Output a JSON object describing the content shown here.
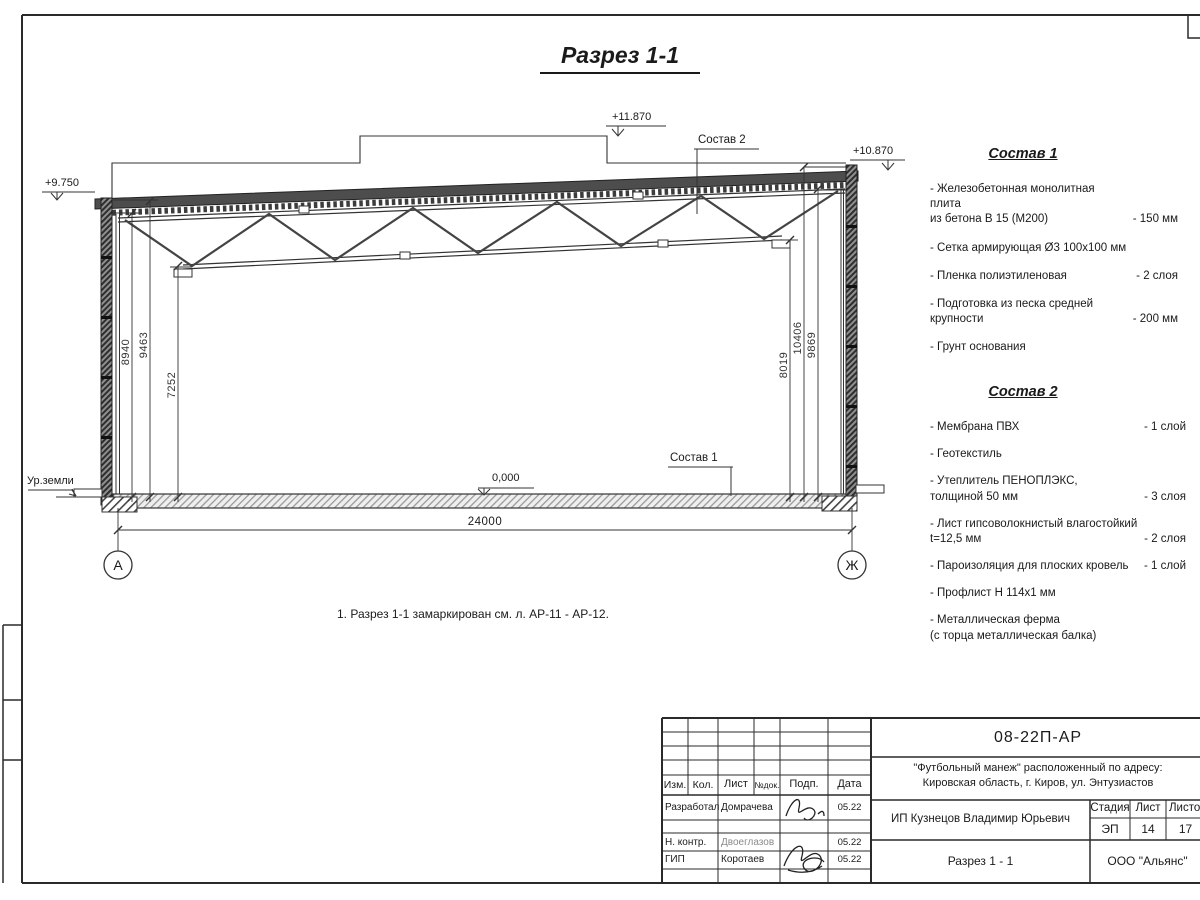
{
  "page": {
    "title": "Разрез 1-1",
    "note": "1. Разрез 1-1 замаркирован см. л. АР-11 - АР-12."
  },
  "section": {
    "elev_box": "+11.870",
    "elev_right": "+10.870",
    "elev_left": "+9.750",
    "elev_floor": "0,000",
    "ground_label": "Ур.земли",
    "leader_comp1": "Состав 1",
    "leader_comp2": "Состав 2",
    "axis_left": "А",
    "axis_right": "Ж",
    "dim_span": "24000",
    "dims_left": [
      "8940",
      "9463",
      "7252"
    ],
    "dims_right": [
      "8019",
      "10406",
      "9869"
    ]
  },
  "comp1": {
    "title": "Состав 1",
    "items": [
      {
        "text": "- Железобетонная  монолитная плита\nиз бетона В 15 (М200)",
        "qty": "- 150 мм"
      },
      {
        "text": "- Сетка армирующая Ø3 100х100 мм",
        "qty": ""
      },
      {
        "text": "- Пленка полиэтиленовая",
        "qty": "-  2 слоя"
      },
      {
        "text": "- Подготовка из песка средней\nкрупности",
        "qty": "- 200 мм"
      },
      {
        "text": "- Грунт основания",
        "qty": ""
      }
    ]
  },
  "comp2": {
    "title": "Состав 2",
    "items": [
      {
        "text": "- Мембрана ПВХ",
        "qty": "- 1 слой"
      },
      {
        "text": "- Геотекстиль",
        "qty": "- 1 слой"
      },
      {
        "text": "- Утеплитель ПЕНОПЛЭКС,\nтолщиной 50 мм",
        "qty": "- 3 слоя"
      },
      {
        "text": "- Лист гипсоволокнистый влагостойкий\nt=12,5 мм",
        "qty": "- 2 слоя"
      },
      {
        "text": "- Пароизоляция для плоских кровель",
        "qty": "- 1 слой"
      },
      {
        "text": "- Профлист Н 114х1 мм",
        "qty": ""
      },
      {
        "text": "- Металлическая ферма\n(с торца металлическая балка)",
        "qty": ""
      }
    ]
  },
  "titleblock": {
    "doc_number": "08-22П-АР",
    "project_line1": "\"Футбольный манеж\" расположенный по адресу:",
    "project_line2": "Кировская область, г. Киров, ул. Энтузиастов",
    "client": "ИП Кузнецов Владимир Юрьевич",
    "drawing_name": "Разрез 1 - 1",
    "company": "ООО \"Альянс\"",
    "stage": "ЭП",
    "sheet": "14",
    "sheets": "17",
    "headers": {
      "izm": "Изм.",
      "kol": "Кол.",
      "list": "Лист",
      "ndok": "№док.",
      "podp": "Подп.",
      "data": "Дата",
      "stage": "Стадия",
      "sheet": "Лист",
      "sheets": "Листов"
    },
    "rows": [
      {
        "role": "Разработал",
        "name": "Домрачева",
        "date": "05.22"
      },
      {
        "role": "Н. контр.",
        "name": "Двоеглазов",
        "date": "05.22"
      },
      {
        "role": "ГИП",
        "name": "Коротаев",
        "date": "05.22"
      }
    ]
  }
}
